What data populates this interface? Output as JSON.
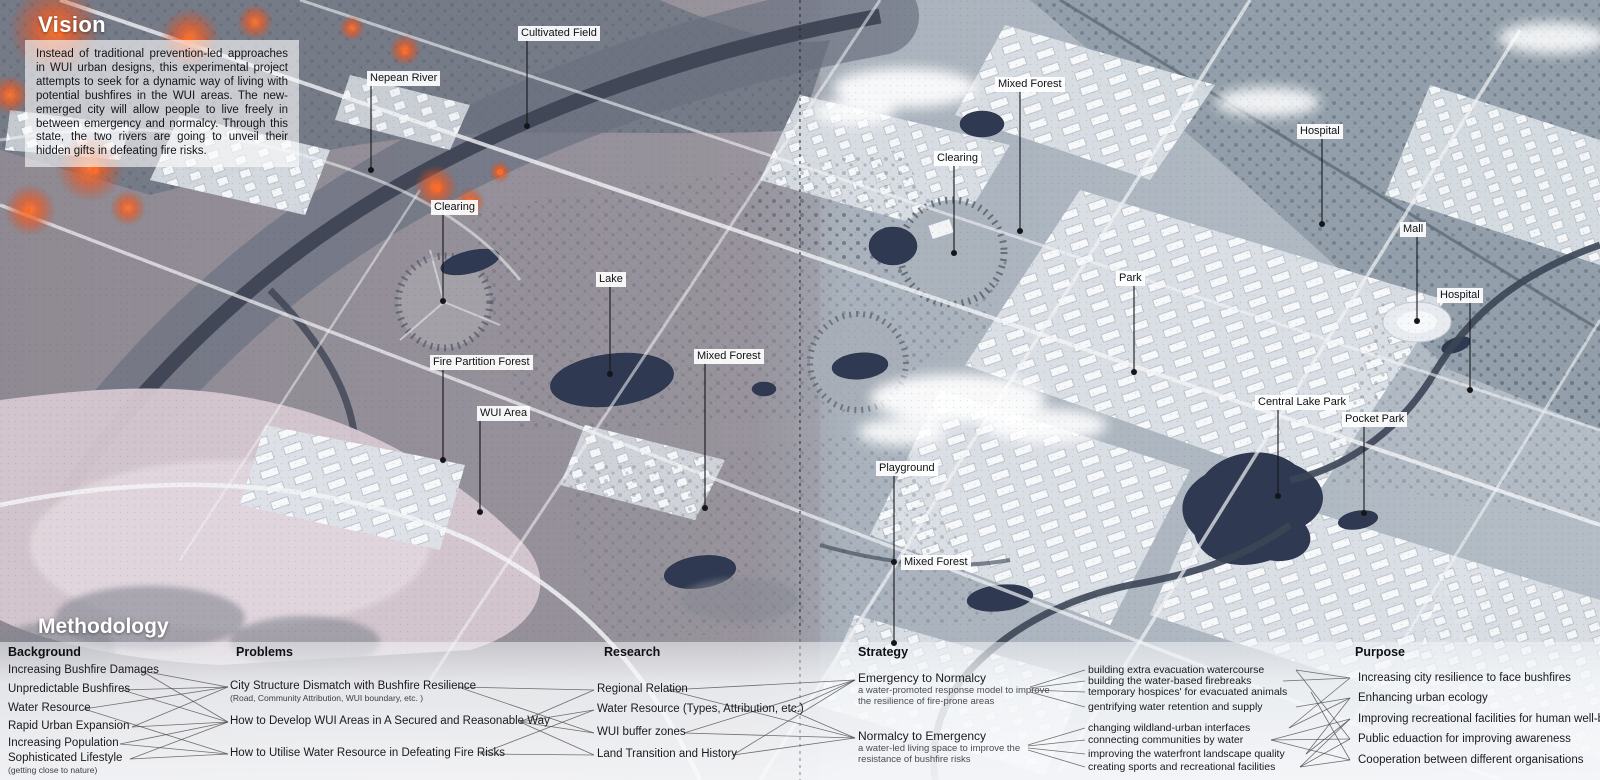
{
  "vision": {
    "title": "Vision",
    "body": "Instead of traditional prevention-led approaches in WUI urban designs, this experimental project attempts to seek for a dynamic way of living with potential bushfires in the WUI areas. The new-emerged city will allow people to live freely in between emergency and normalcy. Through this state, the two rivers are going to unveil their hidden gifts in defeating fire risks."
  },
  "colors": {
    "fire": "#f05a22",
    "water": "#2f3a52",
    "city": "#dde2e7",
    "wild_left": "#8e8894",
    "wild_right": "#93a0ab",
    "field_pink": "#d6c8d0",
    "label_bg": "#ffffff",
    "line": "#15161a"
  },
  "map": {
    "labels": [
      {
        "id": "cultivated-field",
        "text": "Cultivated Field",
        "pos": [
          518,
          26
        ],
        "dot": [
          527,
          126
        ]
      },
      {
        "id": "nepean-river",
        "text": "Nepean River",
        "pos": [
          367,
          71
        ],
        "dot": [
          371,
          170
        ]
      },
      {
        "id": "mixed-forest-north",
        "text": "Mixed Forest",
        "pos": [
          995,
          77
        ],
        "dot": [
          1020,
          231
        ]
      },
      {
        "id": "clearing-north",
        "text": "Clearing",
        "pos": [
          934,
          151
        ],
        "dot": [
          954,
          253
        ]
      },
      {
        "id": "hospital-north",
        "text": "Hospital",
        "pos": [
          1297,
          124
        ],
        "dot": [
          1322,
          224
        ]
      },
      {
        "id": "clearing-west",
        "text": "Clearing",
        "pos": [
          431,
          200
        ],
        "dot": [
          443,
          301
        ]
      },
      {
        "id": "lake",
        "text": "Lake",
        "pos": [
          596,
          272
        ],
        "dot": [
          610,
          374
        ]
      },
      {
        "id": "mall",
        "text": "Mall",
        "pos": [
          1400,
          222
        ],
        "dot": [
          1417,
          321
        ]
      },
      {
        "id": "park",
        "text": "Park",
        "pos": [
          1116,
          271
        ],
        "dot": [
          1134,
          372
        ]
      },
      {
        "id": "hospital-east",
        "text": "Hospital",
        "pos": [
          1437,
          288
        ],
        "dot": [
          1470,
          390
        ]
      },
      {
        "id": "fire-partition-forest",
        "text": "Fire Partition Forest",
        "pos": [
          430,
          355
        ],
        "dot": [
          443,
          460
        ]
      },
      {
        "id": "mixed-forest-central",
        "text": "Mixed Forest",
        "pos": [
          694,
          349
        ],
        "dot": [
          705,
          508
        ]
      },
      {
        "id": "wui-area",
        "text": "WUI Area",
        "pos": [
          477,
          406
        ],
        "dot": [
          480,
          512
        ]
      },
      {
        "id": "central-lake-park",
        "text": "Central Lake Park",
        "pos": [
          1255,
          395
        ],
        "dot": [
          1278,
          496
        ]
      },
      {
        "id": "pocket-park",
        "text": "Pocket Park",
        "pos": [
          1342,
          412
        ],
        "dot": [
          1364,
          513
        ]
      },
      {
        "id": "playground",
        "text": "Playground",
        "pos": [
          876,
          461
        ],
        "dot": [
          894,
          643
        ]
      },
      {
        "id": "mixed-forest-south",
        "text": "Mixed Forest",
        "pos": [
          901,
          555
        ],
        "dot": [
          894,
          562
        ],
        "line": false
      }
    ]
  },
  "methodology": {
    "title": "Methodology",
    "columns": [
      {
        "cls": "col-bg",
        "header": "Background",
        "header_pos": [
          8,
          645
        ],
        "items": [
          {
            "text": "Increasing Bushfire Damages",
            "pos": [
              8,
              664
            ]
          },
          {
            "text": "Unpredictable Bushfires",
            "pos": [
              8,
              683
            ]
          },
          {
            "text": "Water Resource",
            "pos": [
              8,
              702
            ]
          },
          {
            "text": "Rapid Urban Expansion",
            "pos": [
              8,
              720
            ]
          },
          {
            "text": "Increasing Population",
            "pos": [
              8,
              737
            ]
          },
          {
            "text": "Sophisticated Lifestyle",
            "sub": "(getting close to nature)",
            "pos": [
              8,
              752
            ]
          }
        ]
      },
      {
        "cls": "col-prob",
        "header": "Problems",
        "header_pos": [
          236,
          645
        ],
        "items": [
          {
            "text": "City Structure Dismatch with Bushfire Resilience",
            "sub": "(Road, Community Attribution, WUI boundary, etc. )",
            "pos": [
              230,
              680
            ]
          },
          {
            "text": "How to Develop WUI Areas in A Secured and Reasonable Way",
            "pos": [
              230,
              715
            ]
          },
          {
            "text": "How to Utilise Water Resource in Defeating Fire Risks",
            "pos": [
              230,
              747
            ]
          }
        ]
      },
      {
        "cls": "col-res",
        "header": "Research",
        "header_pos": [
          604,
          645
        ],
        "items": [
          {
            "text": "Regional Relation",
            "pos": [
              597,
              683
            ]
          },
          {
            "text": "Water Resource (Types, Attribution, etc.)",
            "pos": [
              597,
              703
            ]
          },
          {
            "text": "WUI buffer zones",
            "pos": [
              597,
              726
            ]
          },
          {
            "text": "Land Transition and History",
            "pos": [
              597,
              748
            ]
          }
        ]
      },
      {
        "cls": "col-strat",
        "header": "Strategy",
        "header_pos": [
          858,
          645
        ],
        "items": [
          {
            "text": "Emergency to Normalcy",
            "desc": "a water-promoted response model to improve the resilience of fire-prone areas",
            "pos": [
              858,
              672
            ]
          },
          {
            "text": "Normalcy to Emergency",
            "desc": "a water-led living space to improve the resistance of bushfire risks",
            "pos": [
              858,
              730
            ]
          }
        ]
      },
      {
        "cls": "col-act",
        "header": "",
        "items": [
          {
            "text": "building extra evacuation watercourse",
            "pos": [
              1088,
              664
            ]
          },
          {
            "text": "building the water-based firebreaks",
            "pos": [
              1088,
              675
            ]
          },
          {
            "text": "temporary hospices' for evacuated animals",
            "pos": [
              1088,
              686
            ]
          },
          {
            "text": "gentrifying water retention and supply",
            "pos": [
              1088,
              701
            ]
          },
          {
            "text": "changing wildland-urban interfaces",
            "pos": [
              1088,
              722
            ]
          },
          {
            "text": "connecting communities by water",
            "pos": [
              1088,
              734
            ]
          },
          {
            "text": "improving the waterfront landscape quality",
            "pos": [
              1088,
              748
            ]
          },
          {
            "text": "creating sports and recreational facilities",
            "pos": [
              1088,
              761
            ]
          }
        ]
      },
      {
        "cls": "col-purp",
        "header": "Purpose",
        "header_pos": [
          1355,
          645
        ],
        "items": [
          {
            "text": "Increasing city resilience to face bushfires",
            "pos": [
              1358,
              672
            ]
          },
          {
            "text": "Enhancing urban ecology",
            "pos": [
              1358,
              692
            ]
          },
          {
            "text": "Improving recreational facilities for human well-being",
            "pos": [
              1358,
              713
            ]
          },
          {
            "text": "Public eduaction for improving awareness",
            "pos": [
              1358,
              733
            ]
          },
          {
            "text": "Cooperation between different organisations",
            "pos": [
              1358,
              754
            ]
          }
        ]
      }
    ],
    "connections": [
      [
        142,
        671,
        228,
        687
      ],
      [
        142,
        671,
        228,
        722
      ],
      [
        122,
        690,
        228,
        687
      ],
      [
        122,
        690,
        228,
        722
      ],
      [
        84,
        709,
        228,
        687
      ],
      [
        84,
        709,
        228,
        754
      ],
      [
        132,
        727,
        228,
        687
      ],
      [
        132,
        727,
        228,
        722
      ],
      [
        120,
        744,
        228,
        722
      ],
      [
        120,
        744,
        228,
        754
      ],
      [
        130,
        759,
        228,
        722
      ],
      [
        130,
        759,
        228,
        754
      ],
      [
        458,
        687,
        594,
        690
      ],
      [
        458,
        687,
        594,
        733
      ],
      [
        520,
        722,
        594,
        690
      ],
      [
        520,
        722,
        594,
        710
      ],
      [
        520,
        722,
        594,
        733
      ],
      [
        520,
        722,
        594,
        755
      ],
      [
        480,
        754,
        594,
        710
      ],
      [
        480,
        754,
        594,
        755
      ],
      [
        668,
        690,
        855,
        680
      ],
      [
        668,
        690,
        855,
        738
      ],
      [
        790,
        710,
        855,
        680
      ],
      [
        790,
        710,
        855,
        738
      ],
      [
        684,
        733,
        855,
        680
      ],
      [
        684,
        733,
        855,
        738
      ],
      [
        733,
        755,
        855,
        680
      ],
      [
        733,
        755,
        855,
        738
      ],
      [
        1030,
        687,
        1085,
        670
      ],
      [
        1030,
        688,
        1085,
        681
      ],
      [
        1030,
        690,
        1085,
        692
      ],
      [
        1030,
        692,
        1085,
        707
      ],
      [
        1028,
        745,
        1085,
        728
      ],
      [
        1028,
        746,
        1085,
        740
      ],
      [
        1028,
        748,
        1085,
        754
      ],
      [
        1028,
        750,
        1085,
        767
      ],
      [
        1296,
        670,
        1350,
        678
      ],
      [
        1283,
        681,
        1350,
        678
      ],
      [
        1289,
        728,
        1350,
        678
      ],
      [
        1296,
        707,
        1350,
        698
      ],
      [
        1306,
        754,
        1350,
        698
      ],
      [
        1289,
        728,
        1350,
        698
      ],
      [
        1306,
        754,
        1350,
        719
      ],
      [
        1300,
        767,
        1350,
        719
      ],
      [
        1271,
        740,
        1350,
        719
      ],
      [
        1296,
        670,
        1350,
        739
      ],
      [
        1271,
        740,
        1350,
        739
      ],
      [
        1300,
        767,
        1350,
        739
      ],
      [
        1311,
        692,
        1350,
        760
      ],
      [
        1271,
        740,
        1350,
        760
      ],
      [
        1300,
        767,
        1350,
        760
      ]
    ]
  }
}
